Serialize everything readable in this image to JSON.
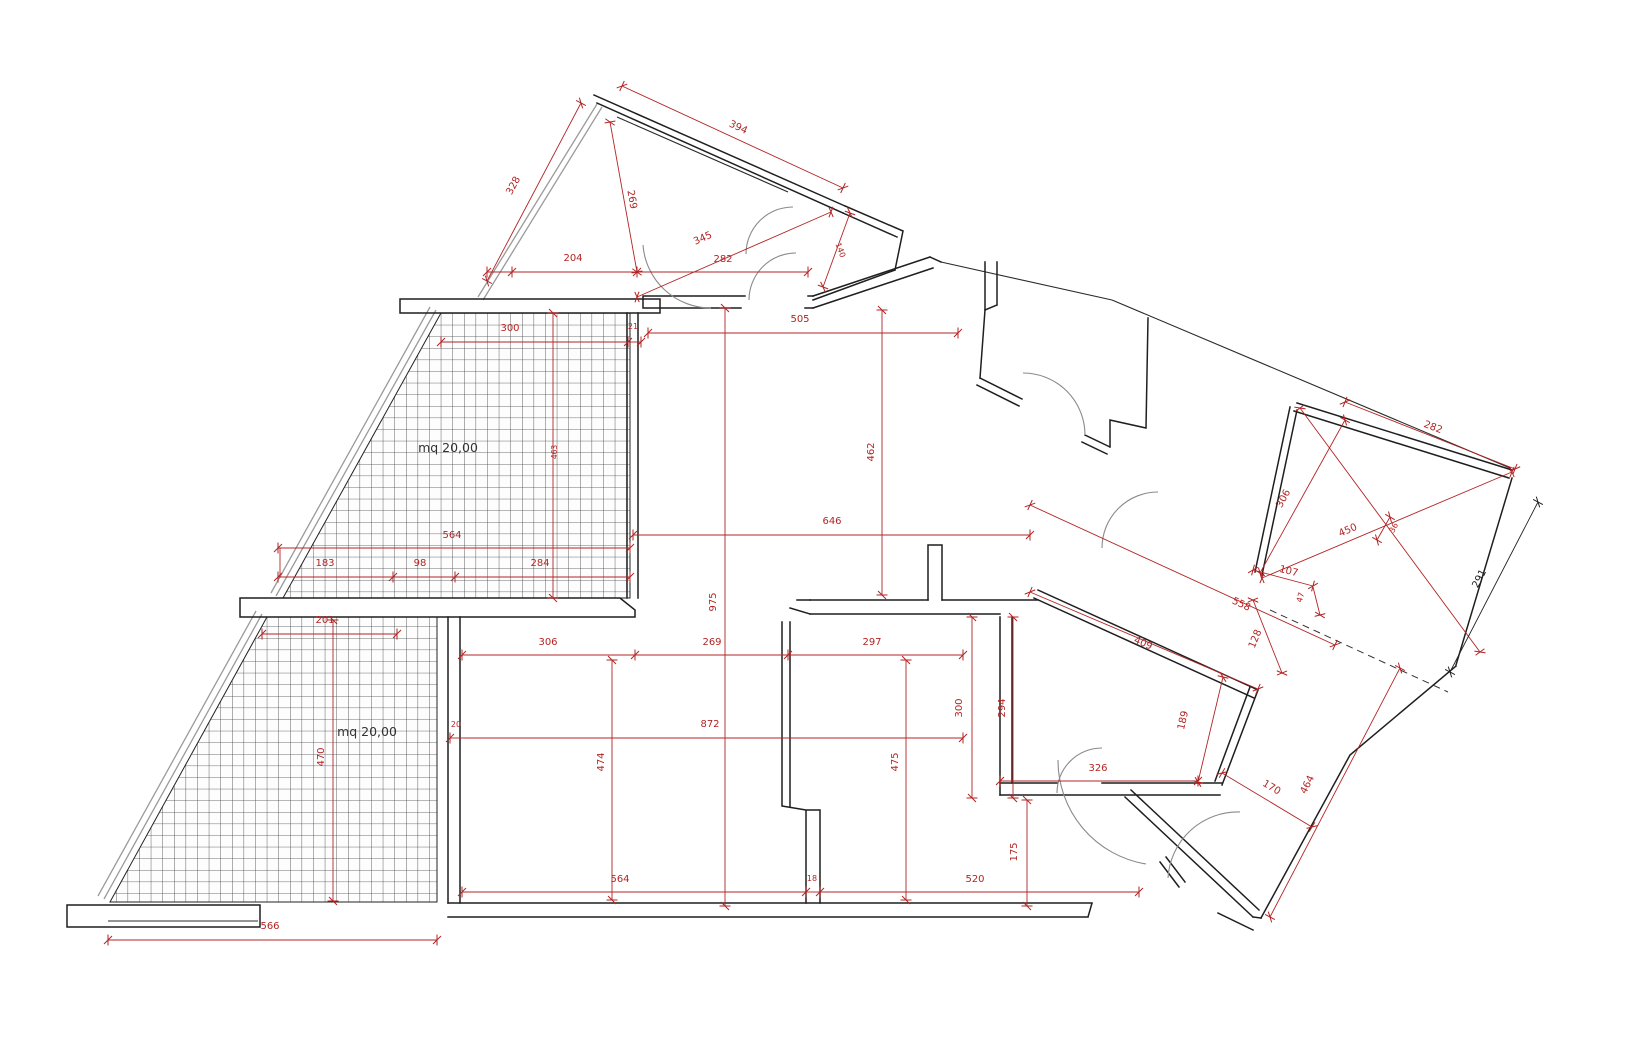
{
  "areas": {
    "upper_terrace": "mq 20,00",
    "lower_terrace": "mq 20,00"
  },
  "dims": {
    "triangle_left": "328",
    "triangle_top": "394",
    "triangle_height": "269",
    "triangle_base_left": "204",
    "triangle_diagonal": "345",
    "triangle_base_right": "282",
    "triangle_right": "140",
    "entry_width": "505",
    "entry_height": "462",
    "living_width": "646",
    "total_height": "975",
    "terr1_top": "300",
    "terr1_wall": "21",
    "terr1_height": "463",
    "terr1_width": "564",
    "terr1_seg1": "183",
    "terr1_seg2": "98",
    "terr1_seg3": "284",
    "terr2_top": "201",
    "terr2_height": "470",
    "terr2_bottom": "566",
    "room1_width": "306",
    "hall_width": "269",
    "room2_width": "297",
    "lower_width": "872",
    "lower_wall": "20",
    "room1_height": "474",
    "room2_height": "475",
    "kitchen_height": "300",
    "kitchen_height2": "294",
    "bottom_seg1": "564",
    "bottom_wall": "18",
    "bottom_seg2": "520",
    "bottom_seg3": "175",
    "wing_hall": "558",
    "wing_diag": "409",
    "wing_depth": "189",
    "wing_width": "326",
    "wing_wall": "128",
    "wing_seg107": "107",
    "wing_seg47": "47",
    "win_top": "282",
    "win_left": "306",
    "win_diag": "450",
    "win_gap": "36",
    "win_side": "291",
    "corr_width": "170",
    "corr_length": "464"
  }
}
